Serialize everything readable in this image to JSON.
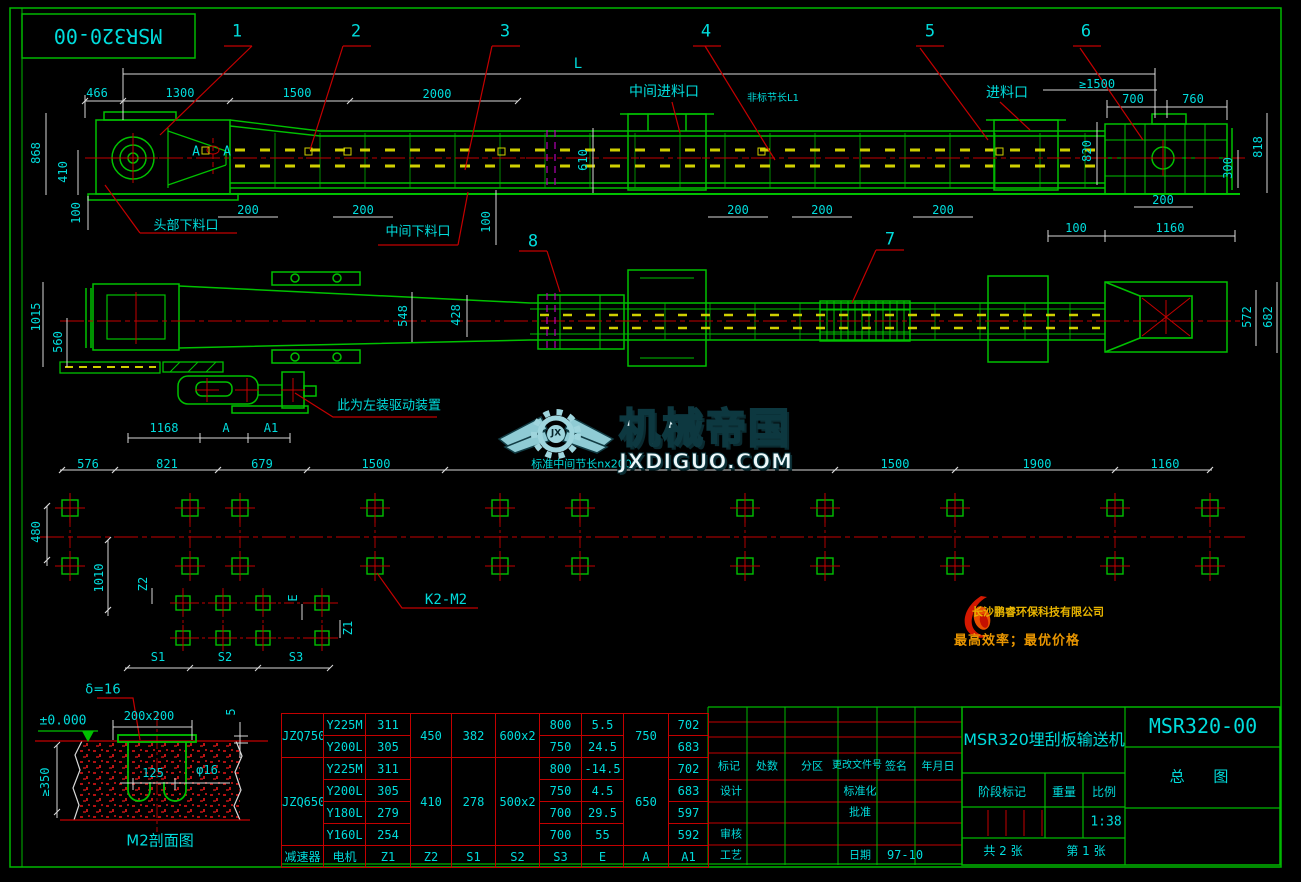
{
  "topbox": {
    "code": "MSR320-00"
  },
  "callouts": {
    "c1": "1",
    "c2": "2",
    "c3": "3",
    "c4": "4",
    "c5": "5",
    "c6": "6",
    "c7": "7",
    "c8": "8"
  },
  "elev": {
    "dim_L": "L",
    "d466": "466",
    "d1300": "1300",
    "d1500": "1500",
    "d2000": "2000",
    "label_mid_inlet": "中间进料口",
    "label_l1": "非标节长L1",
    "label_inlet": "进料口",
    "ge1500": "≥1500",
    "d700": "700",
    "d760": "760",
    "d868": "868",
    "d410": "410",
    "d100a": "100",
    "label_head_outlet": "头部下料口",
    "label_mid_outlet": "中间下料口",
    "d200a": "200",
    "d200b": "200",
    "d100b": "100",
    "d610": "610",
    "d200c": "200",
    "d200d": "200",
    "d200e": "200",
    "d820": "820",
    "d300": "300",
    "d818": "818",
    "d200f": "200",
    "d100c": "100",
    "d1160": "1160",
    "section_a1": "A",
    "section_a2": "A"
  },
  "plan": {
    "d1015": "1015",
    "d560": "560",
    "d548": "548",
    "d428": "428",
    "d572": "572",
    "d682": "682",
    "drive_note": "此为左装驱动装置",
    "d1168": "1168",
    "dA": "A",
    "dA1": "A1"
  },
  "watermark": {
    "brand": "机械帝国",
    "domain": "JXDIGUO.COM",
    "initials": "JX"
  },
  "foundation": {
    "d576": "576",
    "d821": "821",
    "d679": "679",
    "d1500a": "1500",
    "label_nx2000": "标准中间节长nx2000",
    "d1500b": "1500",
    "d1900": "1900",
    "d1160": "1160",
    "d480": "480",
    "d1010": "1010",
    "z2": "Z2",
    "e": "E",
    "z1": "Z1",
    "s1": "S1",
    "s2": "S2",
    "s3": "S3",
    "k2m2": "K2-M2"
  },
  "company": {
    "name": "长沙鹏睿环保科技有限公司",
    "slogan": "最高效率；最优价格"
  },
  "m2": {
    "delta": "δ=16",
    "level": "±0.000",
    "plate": "200x200",
    "d5": "5",
    "d350": "≥350",
    "d125": "125",
    "phi16": "φ16",
    "title": "M2剖面图"
  },
  "table": {
    "col_headers": [
      "减速器",
      "电机",
      "Z1",
      "Z2",
      "S1",
      "S2",
      "S3",
      "E",
      "A",
      "A1"
    ],
    "rows": [
      {
        "reducer": "JZQ750",
        "motor": "Y225M",
        "z1": "311",
        "z2": "450",
        "s1": "382",
        "s2": "600x2",
        "s3": "800",
        "e": "5.5",
        "a": "750",
        "a1": "702"
      },
      {
        "motor": "Y200L",
        "z1": "305",
        "s3": "750",
        "e": "24.5",
        "a1": "683"
      },
      {
        "reducer": "JZQ650",
        "motor": "Y225M",
        "z1": "311",
        "z2": "410",
        "s1": "278",
        "s2": "500x2",
        "s3": "800",
        "e": "-14.5",
        "a": "650",
        "a1": "702"
      },
      {
        "motor": "Y200L",
        "z1": "305",
        "s3": "750",
        "e": "4.5",
        "a1": "683"
      },
      {
        "motor": "Y180L",
        "z1": "279",
        "s3": "700",
        "e": "29.5",
        "a1": "597"
      },
      {
        "motor": "Y160L",
        "z1": "254",
        "s3": "700",
        "e": "55",
        "a1": "592"
      }
    ]
  },
  "titleblock": {
    "rev_h1": "标记",
    "rev_h2": "处数",
    "rev_h3": "分区",
    "rev_h4": "更改文件号",
    "rev_h5": "签名",
    "rev_h6": "年月日",
    "design": "设计",
    "standardize": "标准化",
    "approve": "批准",
    "check": "审核",
    "craft": "工艺",
    "date_label": "日期",
    "date": "97-10",
    "product": "MSR320埋刮板输送机",
    "code": "MSR320-00",
    "sheet_name": "总 图",
    "stage": "阶段标记",
    "weight": "重量",
    "scale_label": "比例",
    "scale": "1:38",
    "total": "共 2 张",
    "page": "第 1 张"
  }
}
